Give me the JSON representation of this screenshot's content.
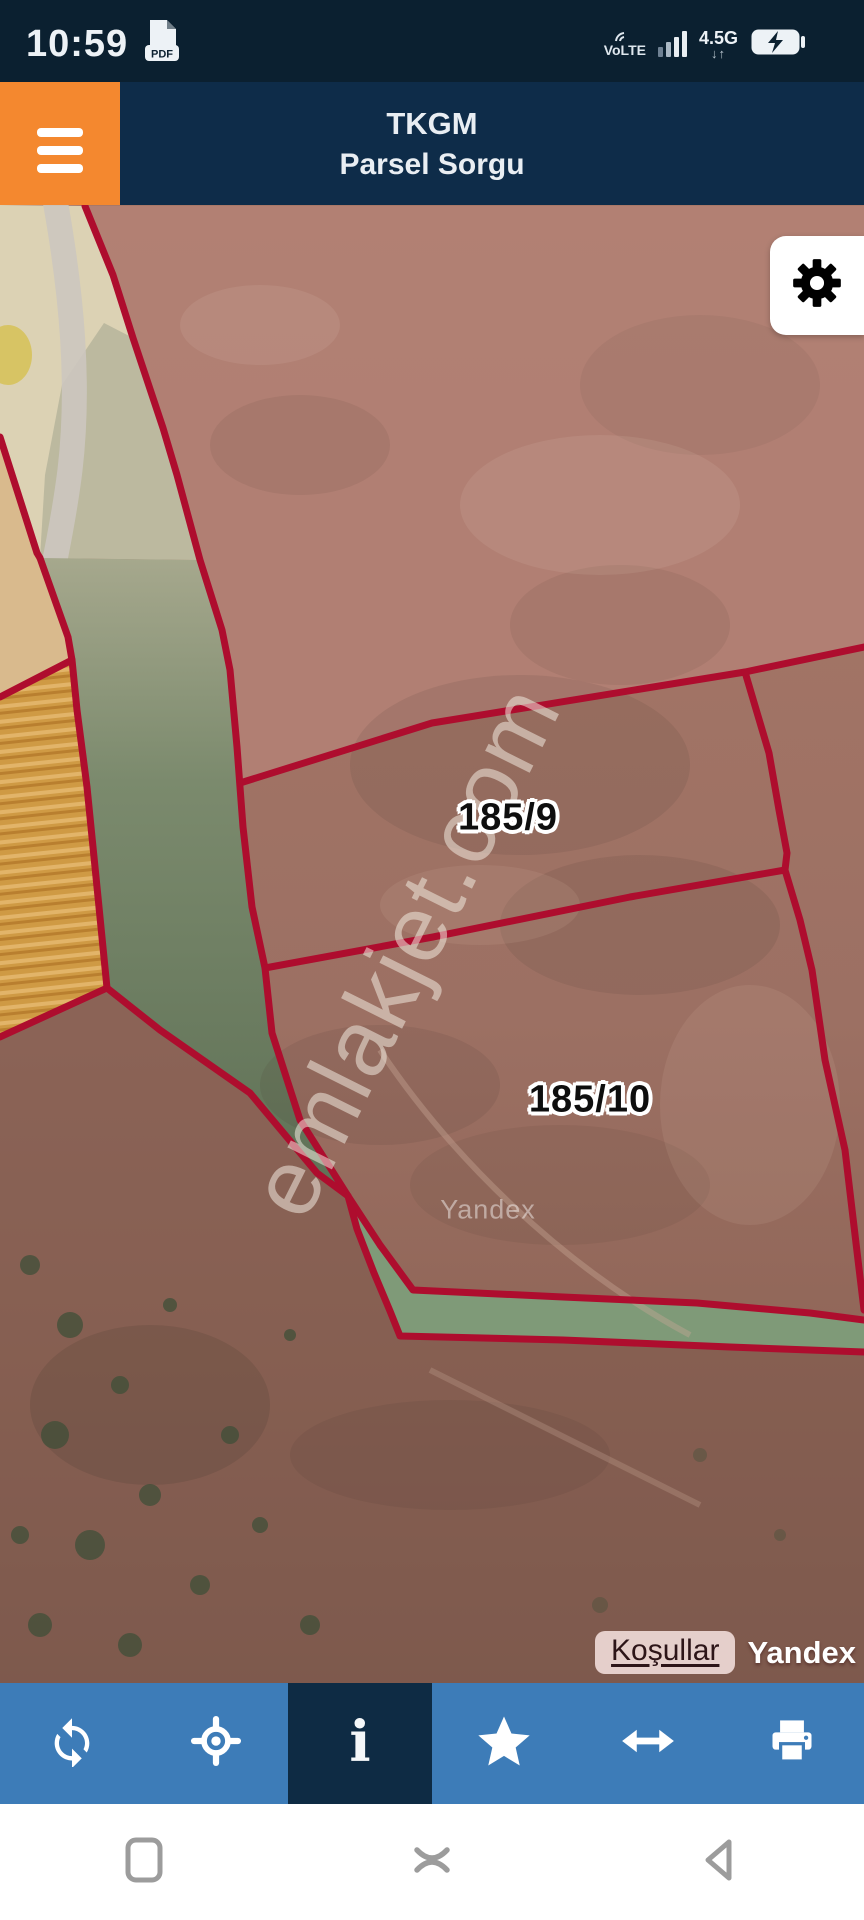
{
  "status_bar": {
    "time": "10:59",
    "pdf_badge": "PDF",
    "volte_label": "VoLTE",
    "network_label": "4.5G",
    "network_arrows": "↓↑"
  },
  "header": {
    "app_title": "TKGM",
    "subtitle": "Parsel Sorgu"
  },
  "map": {
    "parcels": [
      {
        "label": "185/9"
      },
      {
        "label": "185/10"
      }
    ],
    "watermark": "emlakjet.com",
    "provider_watermark": "Yandex",
    "attribution": {
      "terms_link": "Koşullar",
      "provider": "Yandex"
    }
  },
  "toolbar": {
    "items": [
      {
        "name": "refresh"
      },
      {
        "name": "locate"
      },
      {
        "name": "info",
        "active": true,
        "glyph": "i"
      },
      {
        "name": "favorite"
      },
      {
        "name": "measure"
      },
      {
        "name": "print"
      }
    ]
  },
  "nav_bar": {
    "items": [
      "recents",
      "home",
      "back"
    ]
  },
  "colors": {
    "status_bar": "#0b2030",
    "header": "#0e2c49",
    "menu_button": "#f4882f",
    "parcel_line": "#ae0d2e",
    "toolbar": "#3d7cb8",
    "toolbar_active": "#0e2b44",
    "attribution_pill": "#f6e4e2"
  }
}
